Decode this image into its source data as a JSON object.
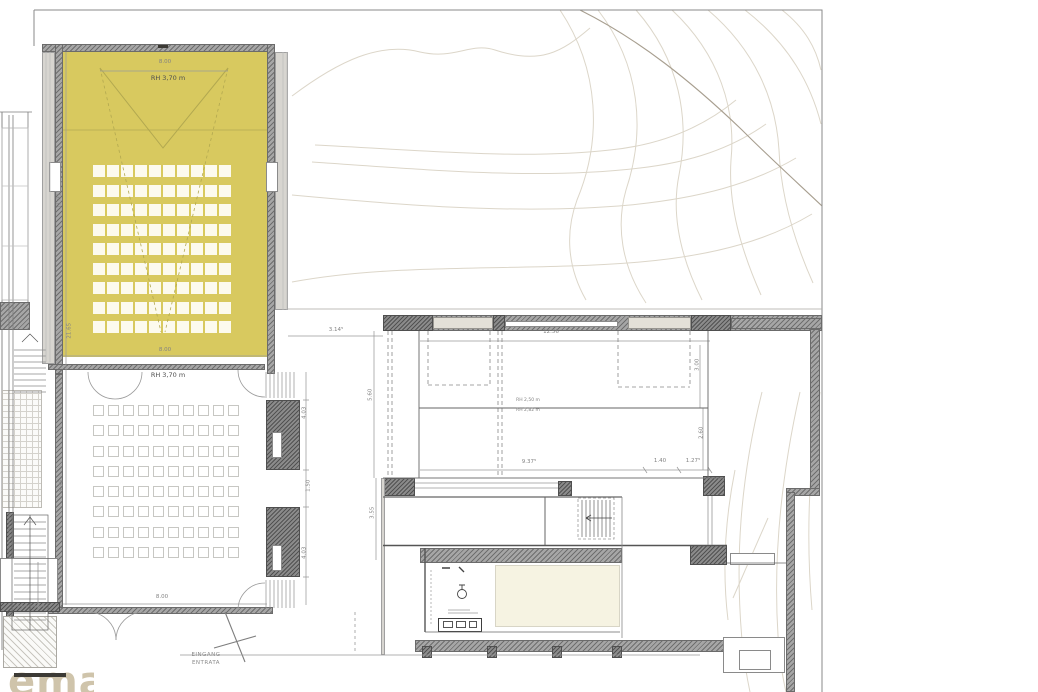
{
  "site": {
    "entrance_line1": "EINGANG",
    "entrance_line2": "ENTRATA"
  },
  "upper_hall": {
    "rh_label": "RH 3,70 m",
    "dim_top": "8.00",
    "dim_bottom": "8.00",
    "dim_left": "11.91",
    "dim_left_outer": "21.65",
    "seat_rows": 9,
    "seat_cols": 10
  },
  "lower_hall": {
    "rh_label": "RH 3,70 m",
    "dim_bottom": "8.00",
    "dim_left": "9.36",
    "dim_right_top": "4.03",
    "dim_right_mid": "1.50",
    "dim_right_bottom": "4.03",
    "seat_rows": 8,
    "seat_cols": 10
  },
  "annex": {
    "dim_top": "12.56",
    "dim_right_upper": "3.00",
    "dim_right_lower": "2.60",
    "dim_left_top": "3.14⁵",
    "dim_left_upper": "5.60",
    "dim_left_lower": "3.55",
    "rh_line1": "RH 2,50 m",
    "rh_line2": "RH 2,82 m",
    "dim_bottom_left": "9.37⁵",
    "dim_bottom_mid": "1.40",
    "dim_bottom_right": "1.27⁵"
  },
  "logo": {
    "text": "ema"
  },
  "colors": {
    "hall_fill": "#d8c95f",
    "wall_gray": "#a6a6a6",
    "contour": "#dcd6c9",
    "contour_dark": "#a79e8f",
    "cream": "#f6f3e2"
  }
}
